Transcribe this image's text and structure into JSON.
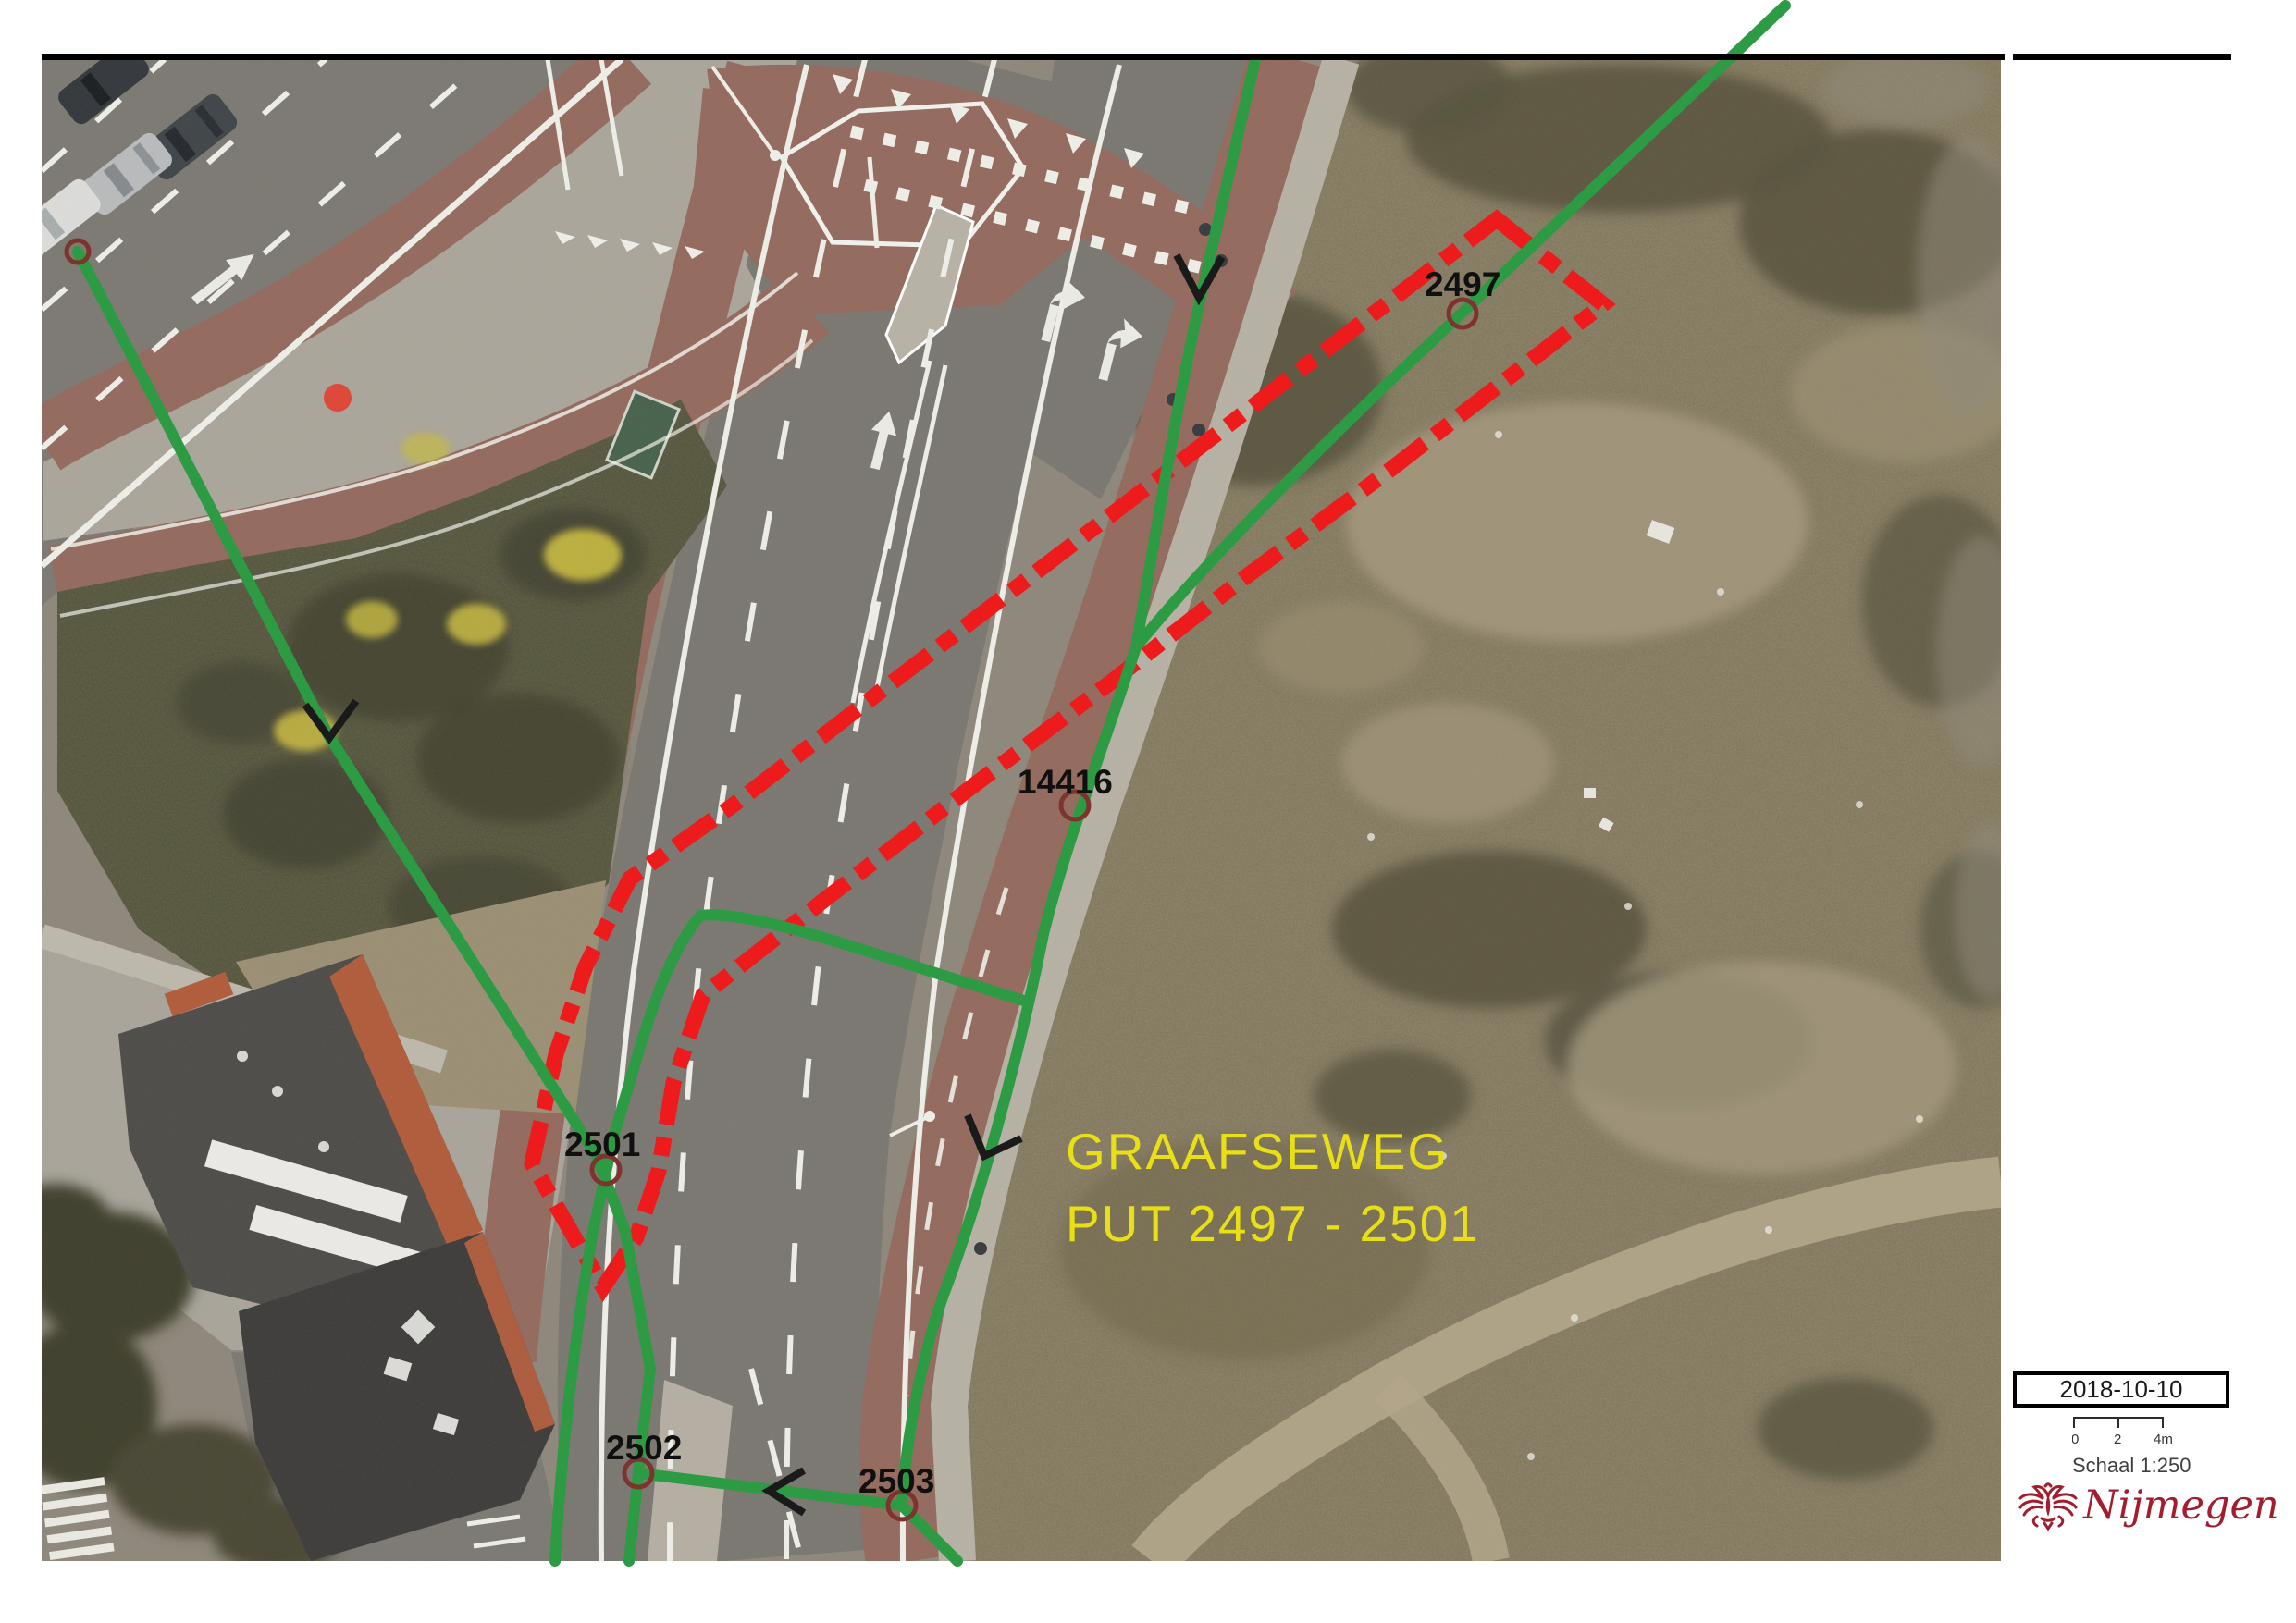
{
  "map": {
    "annotation": {
      "line1": "GRAAFSEWEG",
      "line2": "PUT 2497 - 2501"
    },
    "labels": {
      "put_2497": "2497",
      "put_14416": "14416",
      "put_2501": "2501",
      "put_2502": "2502",
      "put_2503": "2503"
    },
    "colors": {
      "pipe_green": "#2d9b43",
      "trace_red": "#ee1b1c",
      "annotation_yellow": "#e9df17"
    }
  },
  "titleblock": {
    "date": "2018-10-10",
    "scale": {
      "tick_0": "0",
      "tick_2": "2",
      "tick_4": "4m",
      "label": "Schaal 1:250"
    },
    "logo": {
      "text": "Nijmegen",
      "color": "#a21e2f"
    }
  }
}
